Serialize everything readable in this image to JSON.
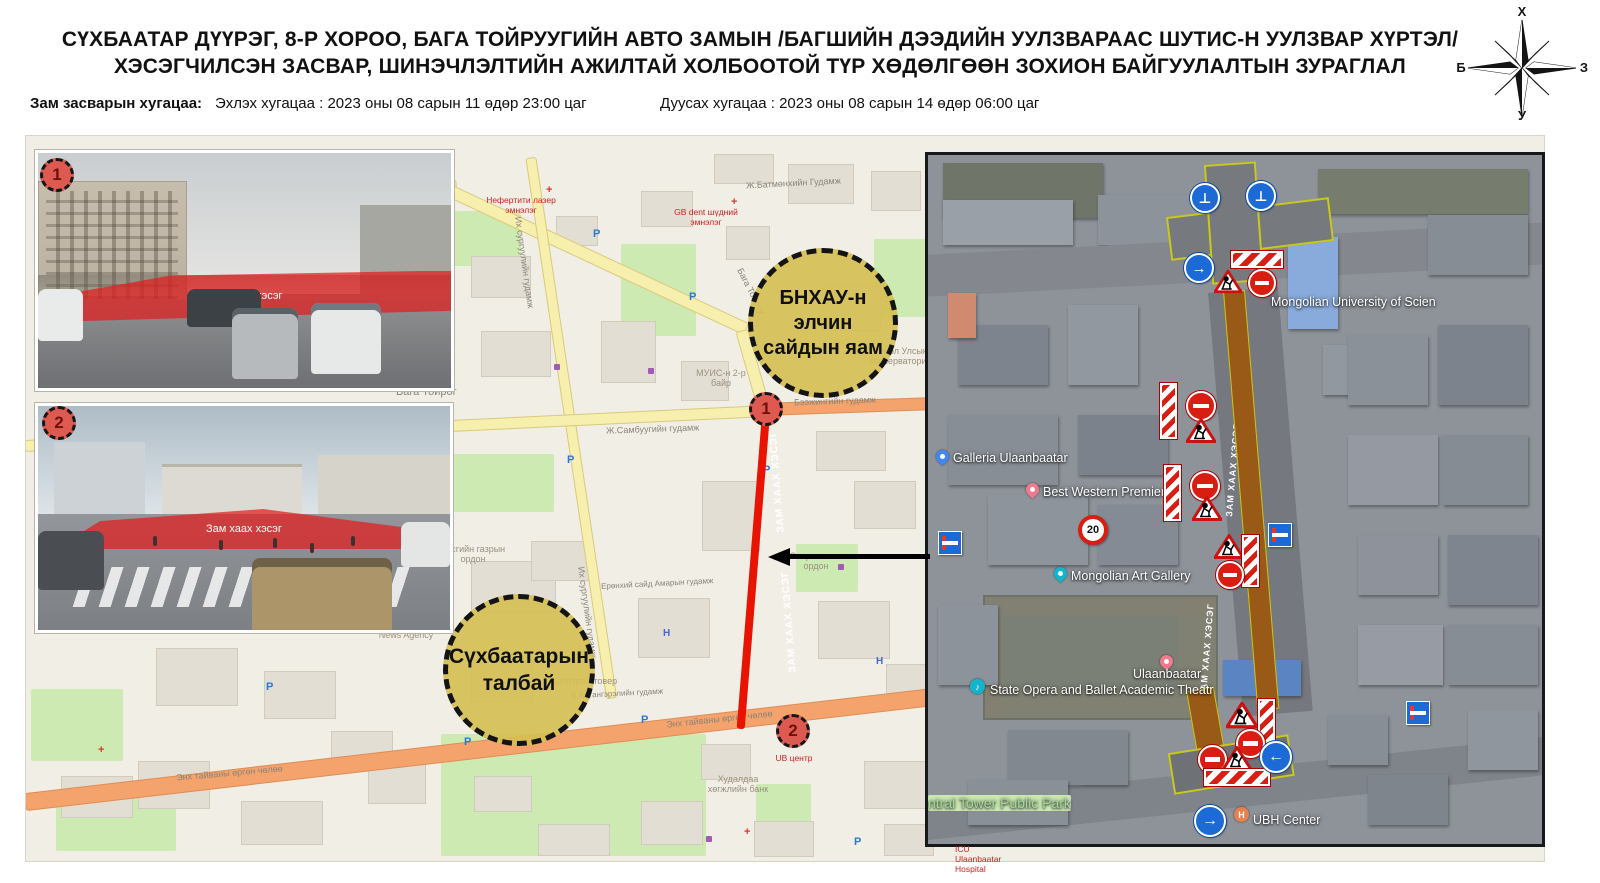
{
  "header": {
    "title_line1": "СҮХБААТАР ДҮҮРЭГ, 8-Р ХОРОО, БАГА ТОЙРУУГИЙН АВТО ЗАМЫН /БАГШИЙН ДЭЭДИЙН УУЛЗВАРААС ШУТИС-Н УУЛЗВАР ХҮРТЭЛ/",
    "title_line2": "ХЭСЭГЧИЛСЭН ЗАСВАР, ШИНЭЧЛЭЛТИЙН АЖИЛТАЙ ХОЛБООТОЙ ТҮР ХӨДӨЛГӨӨН ЗОХИОН БАЙГУУЛАЛТЫН ЗУРАГЛАЛ",
    "duration_label": "Зам засварын хугацаа:",
    "start_time": "Эхлэх хугацаа : 2023 оны 08 сарын 11 өдөр 23:00 цаг",
    "end_time": "Дуусах хугацаа : 2023 оны 08 сарын 14 өдөр 06:00 цаг"
  },
  "compass": {
    "north": "Х",
    "east": "З",
    "south": "У",
    "west": "Б"
  },
  "photos": [
    {
      "number": "1",
      "overlay_label": "Зам хаах хэсэг"
    },
    {
      "number": "2",
      "overlay_label": "Зам хаах хэсэг"
    }
  ],
  "street_map": {
    "callout_embassy": "БНХАУ-н элчин сайдын яам",
    "callout_square": "Сүхбаатарын талбай",
    "marker1": "1",
    "marker2": "2",
    "route_label": "ЗАМ ХААХ ХЭСЭГ",
    "streets": {
      "baga_toiruu": "Бага Тойруу",
      "baga_toirog": "Бага Тойрог",
      "ikh_surguuliin": "Их сургуулийн гудамж",
      "batmunkh": "Ж.Батмөнхийн Гудамж",
      "sambuu": "Ж.Самбуугийн гудамж",
      "beijing": "Бээжингийн гудамж",
      "peace_avenue": "Энх тайваны өргөн чөлөө",
      "altangerel": "Б.Алтангэрэлийн гудамж",
      "amar": "Ерөнхий сайд Амарын гудамж"
    },
    "pois": {
      "nefertiti": "Нефертити лазер эмнэлэг",
      "gb_dent": "GB dent шүдний эмнэлэг",
      "muis": "МУИС-н 2-р байр",
      "conservatory": "Монгол Улсын консерватори",
      "government": "Засгийн газрын ордон",
      "sport": "Спортын төв ордон",
      "central_tower": "Централ товер",
      "news_agency": "News Agency",
      "tdb": "Худалдаа хөгжлийн банк",
      "ub_center": "UB центр"
    },
    "parking_icon": "P",
    "hotel_icon": "Н"
  },
  "satellite_map": {
    "route_label": "ЗАМ ХААХ ХЭСЭГ",
    "speed_limit": "20",
    "labels": {
      "university": "Mongolian University of Scien",
      "galleria": "Galleria Ulaanbaatar",
      "best_western": "Best Western Premier",
      "art_gallery": "Mongolian Art Gallery",
      "ulaanbaatar": "Ulaanbaatar",
      "opera": "State Opera and Ballet Academic Theatr",
      "park": "ntral Tower Public Park",
      "ubh": "UBH Center",
      "icu": "ICU Ulaanbaatar Hospital"
    },
    "hotel_pin_letter": "H",
    "music_icon": "♪"
  }
}
